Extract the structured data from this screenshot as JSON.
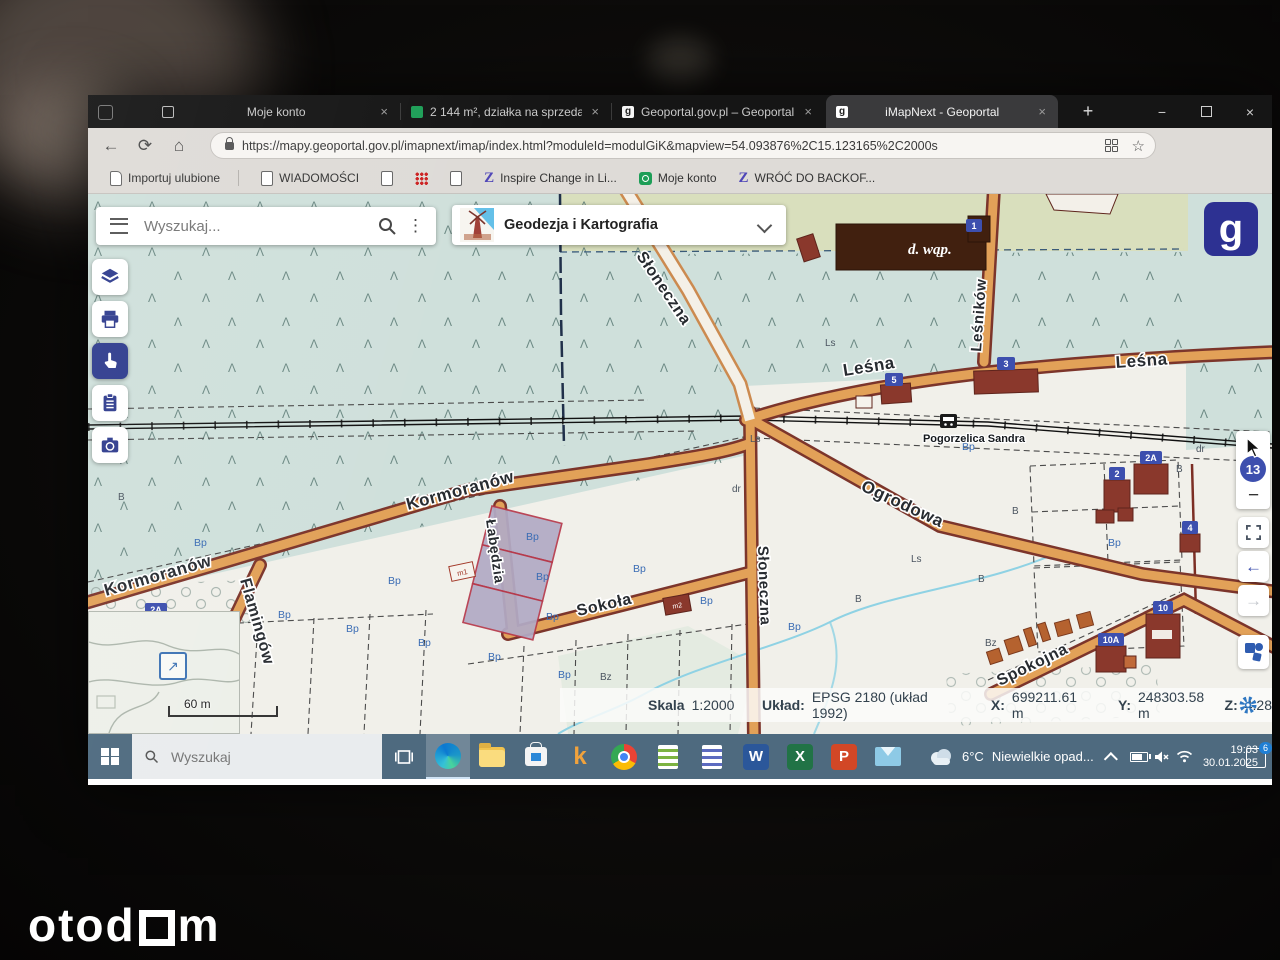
{
  "colors": {
    "accent_navy": "#2d3192",
    "road_orange": "#e2a158",
    "road_casing": "#7c352b",
    "forest_teal": "#cfe0db",
    "olive_field": "#d9dfbd",
    "taskbar_blue": "#4e6a7f",
    "badge_blue": "#3d4fae",
    "parcel_purple": "#b2abc5"
  },
  "browser": {
    "tabs": [
      {
        "title": "Moje konto"
      },
      {
        "title": "2 144 m², działka na sprzedaż -"
      },
      {
        "title": "Geoportal.gov.pl – Geoportal In"
      },
      {
        "title": "iMapNext - Geoportal"
      }
    ],
    "url": "https://mapy.geoportal.gov.pl/imapnext/imap/index.html?moduleId=modulGiK&mapview=54.093876%2C15.123165%2C2000s",
    "bookmarks": [
      "Importuj ulubione",
      "WIADOMOŚCI",
      "Inspire Change in Li...",
      "Moje konto",
      "WRÓĆ DO BACKOF..."
    ]
  },
  "app": {
    "search_placeholder": "Wyszukaj...",
    "module_title": "Geodezja i Kartografia",
    "zoom_badge": "13"
  },
  "map": {
    "streets": [
      "Słoneczna",
      "Leśna",
      "Leśników",
      "Kormoranów",
      "Łabędzia",
      "Sokoła",
      "Flamingów",
      "Ogrodowa",
      "Spokojna"
    ],
    "railway_station": "Pogorzelica Sandra",
    "dwap_label": "d. wąp.",
    "scale_bar": "60 m",
    "badges": {
      "b3": "3",
      "b5": "5",
      "b1": "1",
      "b2a": "2A",
      "b2": "2",
      "b4": "4",
      "b10": "10",
      "b10a": "10A"
    },
    "small_bldg": {
      "m1": "m1",
      "m2": "m2"
    },
    "land": {
      "bp": "Bp",
      "b": "B",
      "bz": "Bz",
      "ls": "Ls",
      "dr": "dr"
    }
  },
  "statusbar": {
    "scale_label": "Skala",
    "scale_value": "1:2000",
    "crs_label": "Układ:",
    "crs_value": "EPSG 2180 (układ 1992)",
    "x_label": "X:",
    "x_value": "699211.61 m",
    "y_label": "Y:",
    "y_value": "248303.58 m",
    "z_label": "Z:",
    "z_value": "4.28"
  },
  "taskbar": {
    "search_placeholder": "Wyszukaj",
    "weather_temp": "6°C",
    "weather_text": "Niewielkie opad...",
    "time": "19:03",
    "date": "30.01.2025",
    "notification_count": "6"
  },
  "watermark": {
    "part1": "otod",
    "part2": "m"
  },
  "glyphs": {
    "close": "×",
    "minimize": "−",
    "new_tab": "+",
    "back": "←",
    "forward": "→",
    "refresh": "⟳",
    "home": "⌂",
    "dots_v": "⋮",
    "dots_h": "⋯",
    "star": "☆",
    "tree": "Λ",
    "expand": "↗",
    "z": "Z",
    "k": "k",
    "w": "W",
    "x": "X",
    "p": "P",
    "g": "g"
  }
}
